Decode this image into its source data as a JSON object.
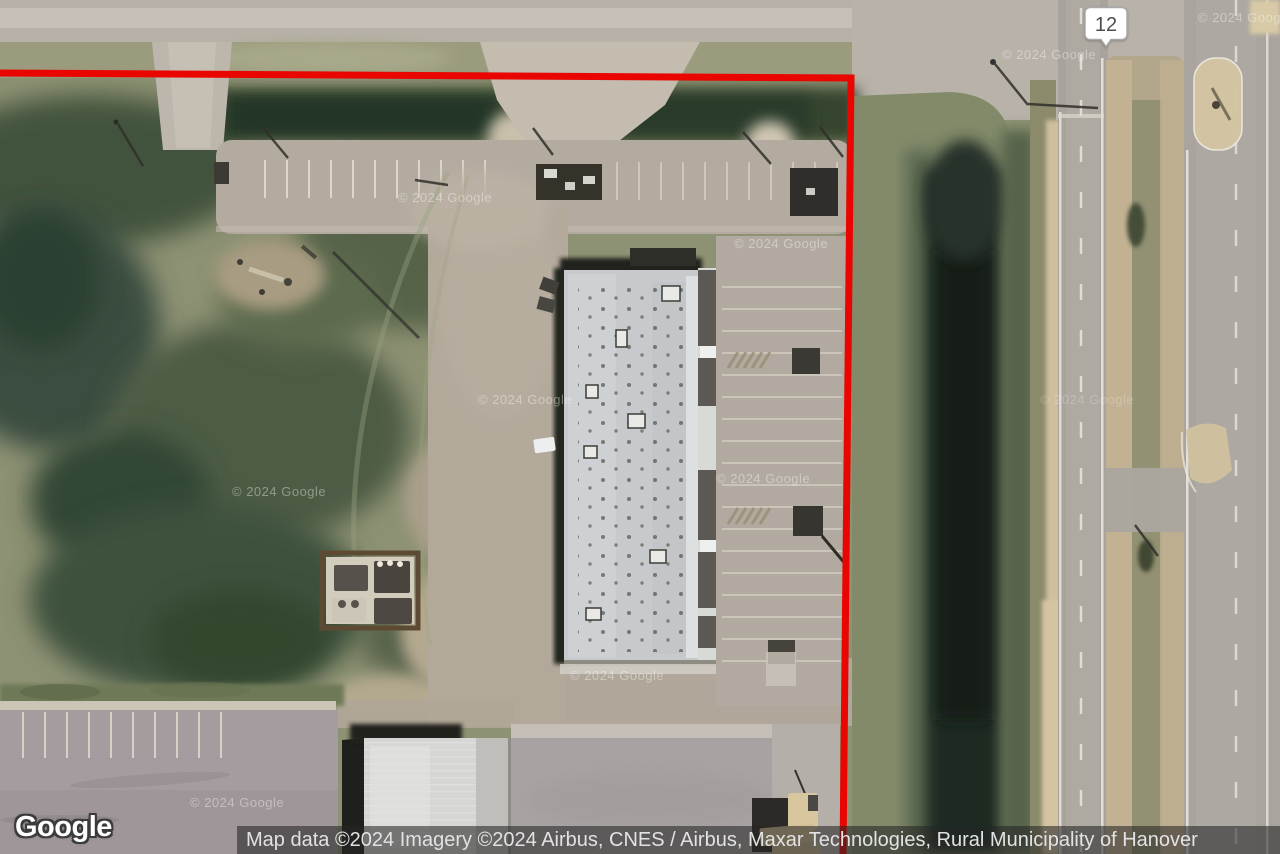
{
  "map": {
    "google_logo": "Google",
    "watermark": "© 2024 Google",
    "route_marker": {
      "label": "12"
    },
    "boundary": {
      "color": "#e90500"
    },
    "attribution": "Map data ©2024 Imagery ©2024 Airbus, CNES / Airbus, Maxar Technologies, Rural Municipality of Hanover"
  }
}
